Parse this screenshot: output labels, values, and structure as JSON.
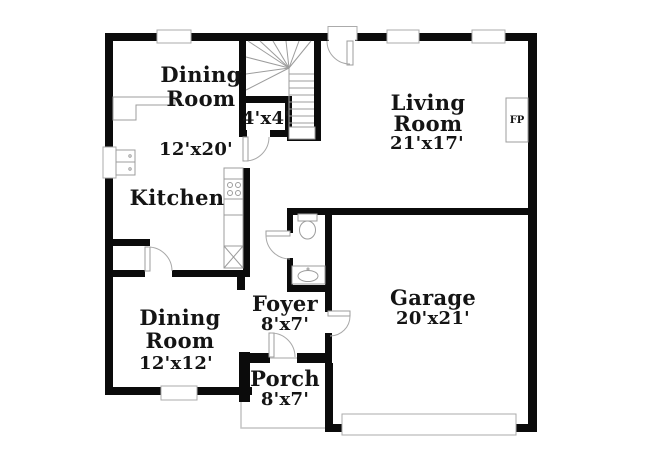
{
  "colors": {
    "wall": "#0b0b0b",
    "background": "#ffffff",
    "fixture_line": "#9c9c9c"
  },
  "rooms": {
    "dining_room_top": {
      "lines": [
        "Dining",
        "Room"
      ],
      "dims": "12'x20'"
    },
    "stair_closet": {
      "dims": "4'x4'"
    },
    "living_room": {
      "lines": [
        "Living",
        "Room"
      ],
      "dims": "21'x17'"
    },
    "kitchen": {
      "lines": [
        "Kitchen"
      ]
    },
    "dining_room_bottom": {
      "lines": [
        "Dining",
        "Room"
      ],
      "dims": "12'x12'"
    },
    "foyer": {
      "lines": [
        "Foyer"
      ],
      "dims": "8'x7'"
    },
    "garage": {
      "lines": [
        "Garage"
      ],
      "dims": "20'x21'"
    },
    "porch": {
      "lines": [
        "Porch"
      ],
      "dims": "8'x7'"
    }
  },
  "fireplace": {
    "label": "FP"
  }
}
